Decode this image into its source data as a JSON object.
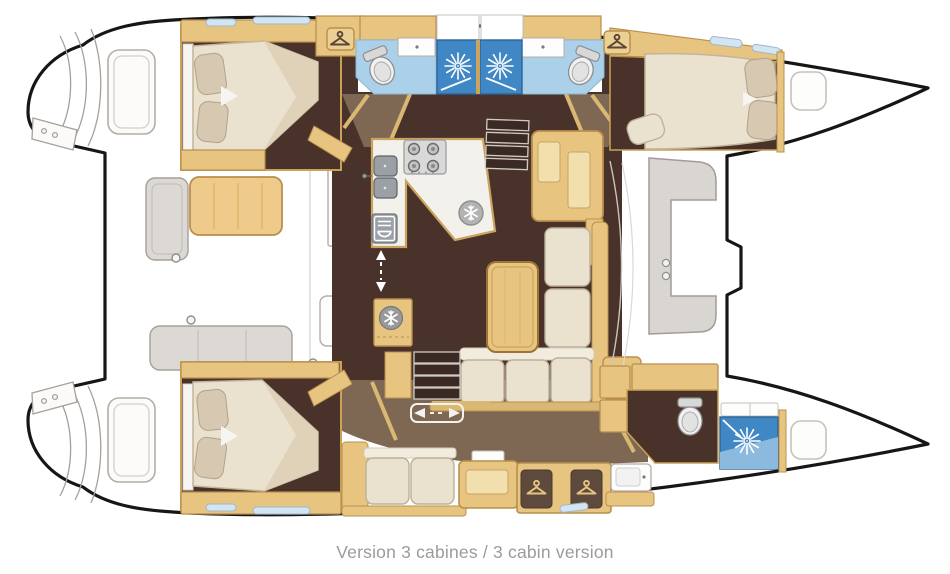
{
  "caption": "Version 3 cabines / 3 cabin version",
  "diagram": {
    "type": "boat-floor-plan",
    "vessel_type": "sailing catamaran (top view, bow to the right)",
    "cabins_with_double_beds": 3,
    "heads_with_toilet": 3,
    "shower_stalls": 3,
    "wardrobe_hanger_symbols": 4,
    "refrigeration_snowflake_symbols": 2
  },
  "icons": {
    "shower": "shower-sunburst-icon",
    "wardrobe": "clothes-hanger-icon",
    "fridge": "snowflake-icon",
    "freezer": "snowflake-icon",
    "stove": "four-burner-stove-icon",
    "oven": "oven-cutlery-icon",
    "toilet": "toilet-icon",
    "sliding_door_vertical": "up-down-arrow-icon",
    "sliding_door_horizontal": "left-right-arrow-icon"
  },
  "palette": {
    "hull_outline": "#161616",
    "wood_trim": "#e7c580",
    "wood_light": "#f2dfae",
    "floor_dark_brown": "#48322a",
    "floor_mid_brown": "#7e6854",
    "bathroom_floor_blue": "#abd0e9",
    "shower_blue": "#3f87c5",
    "upholstery_cream": "#eae1cf",
    "pillow_beige": "#d6c8b1",
    "deck_gray": "#dcd8d3",
    "window_blue": "#d3e5f3",
    "caption_gray": "#9b9b9b"
  }
}
